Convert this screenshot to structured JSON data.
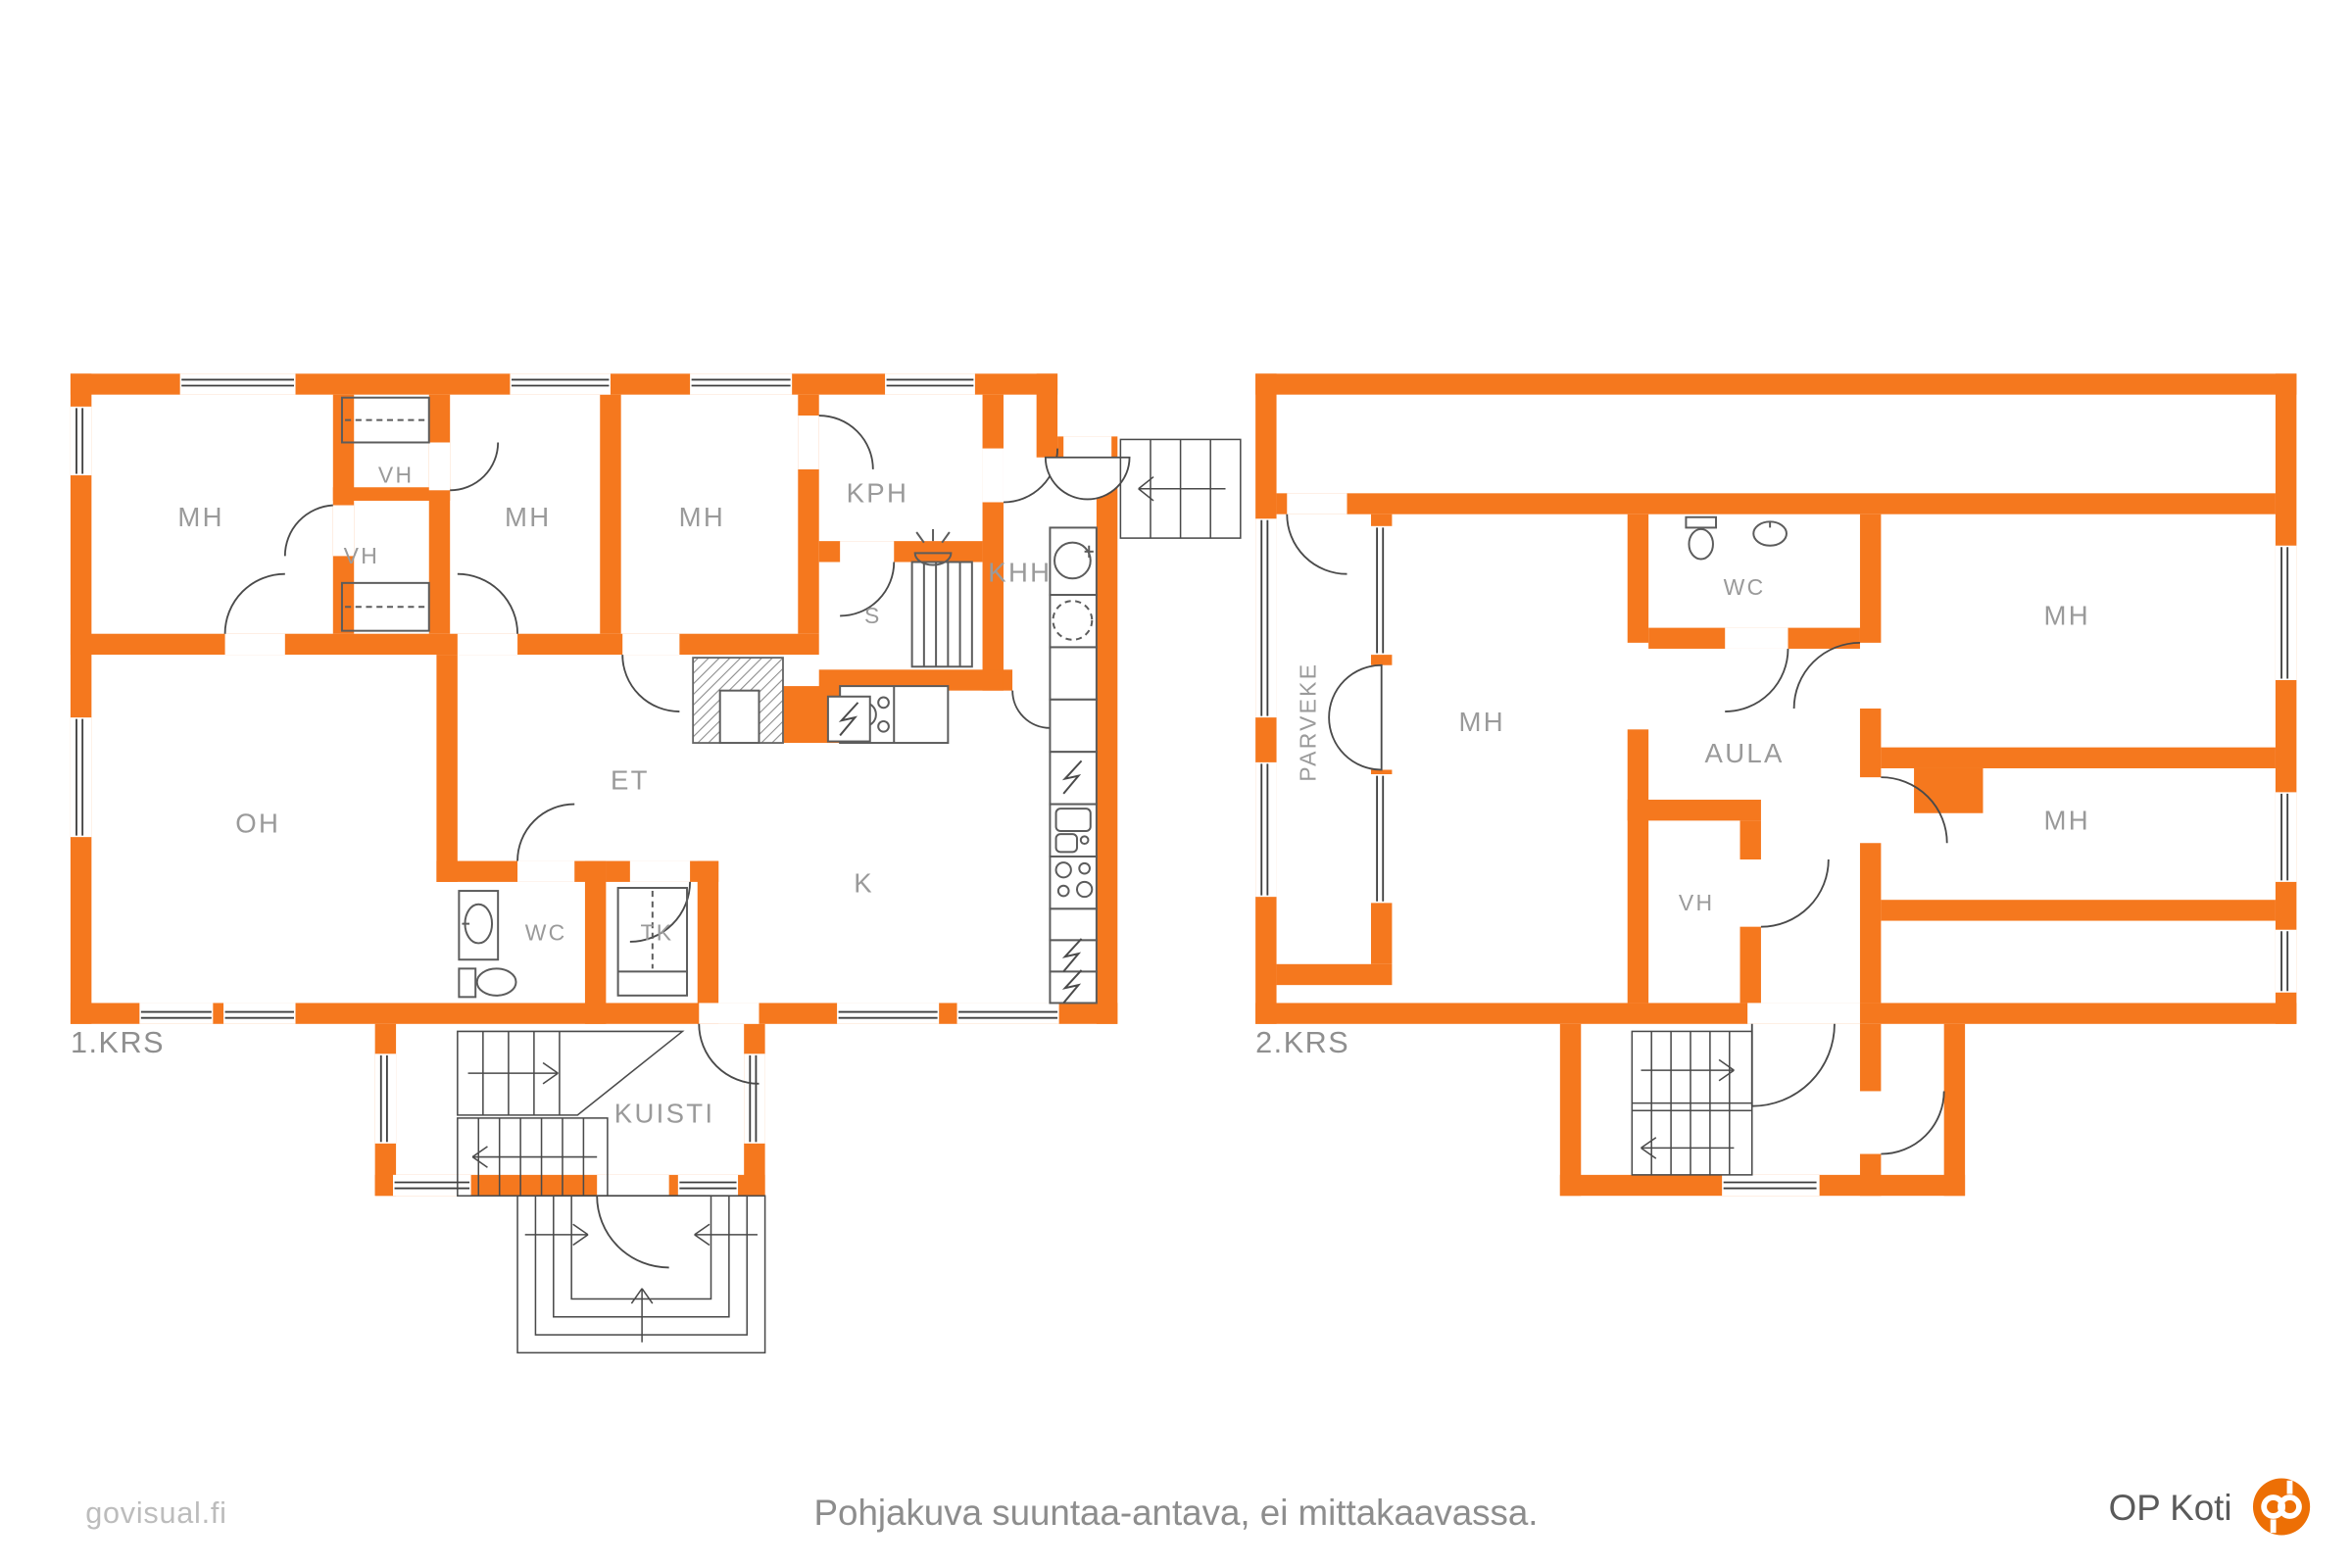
{
  "title": "Kaksikerroksisen talon pohjakuva",
  "colors": {
    "wall": "#F5781E",
    "room_label": "#9A9A9A",
    "floor_label": "#8F8F8F",
    "fixture_line": "#5C5C5C",
    "window_line": "#3F3F3F",
    "footer_text": "#8D8D8D",
    "watermark": "#BCBCBC",
    "op_orange": "#ED6F05",
    "op_text": "#5A5A5A"
  },
  "floor1": {
    "label": "1.KRS",
    "rooms": [
      {
        "label": "MH"
      },
      {
        "label": "VH"
      },
      {
        "label": "VH"
      },
      {
        "label": "MH"
      },
      {
        "label": "MH"
      },
      {
        "label": "KPH"
      },
      {
        "label": "KHH"
      },
      {
        "label": "S"
      },
      {
        "label": "OH"
      },
      {
        "label": "ET"
      },
      {
        "label": "WC"
      },
      {
        "label": "TK"
      },
      {
        "label": "K"
      },
      {
        "label": "KUISTI"
      }
    ]
  },
  "floor2": {
    "label": "2.KRS",
    "rooms": [
      {
        "label": "PARVEKE"
      },
      {
        "label": "MH"
      },
      {
        "label": "WC"
      },
      {
        "label": "AULA"
      },
      {
        "label": "MH"
      },
      {
        "label": "MH"
      },
      {
        "label": "VH"
      }
    ]
  },
  "icons": [
    "water-heater-icon",
    "washing-machine-icon",
    "electric-appliance-icon",
    "kitchen-sink-icon",
    "stove-icon",
    "cooktop-icon",
    "toilet-icon",
    "washbasin-icon",
    "sauna-stove-icon",
    "sauna-bench",
    "electrical-panel-icon",
    "fireplace",
    "wardrobe",
    "stairs",
    "door-swing",
    "window"
  ],
  "footer": {
    "watermark": "govisual.fi",
    "disclaimer": "Pohjakuva suuntaa-antava, ei mittakaavassa.",
    "brand": "OP Koti"
  }
}
